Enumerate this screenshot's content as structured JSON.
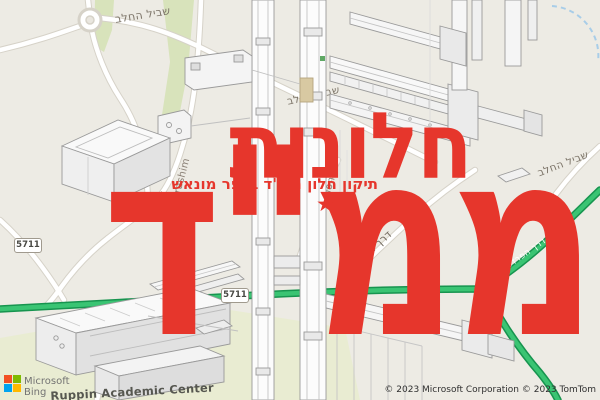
{
  "theme": {
    "accent_red": "#e6362c",
    "road_green_fill": "#3ac473",
    "road_green_edge": "#17944f",
    "map_bg": "#edebe4",
    "veg_green": "#d8e3bb",
    "campus_green": "#e9ecd2",
    "water_blue": "#a8cde8",
    "label_gray": "#7c7468",
    "cad_line": "#9a9a9a",
    "logo_red": "#f25022",
    "logo_green": "#7fba00",
    "logo_blue": "#00a4ef",
    "logo_yellow": "#ffb900"
  },
  "overlay": {
    "title_line1": "חלונות",
    "title_line2": "ממ\"ד",
    "subtitle": "תיקון חלון ממ\"ד בכפר מונאש",
    "star": "★"
  },
  "map": {
    "shield1": "5711",
    "shield2": "5711",
    "labels": {
      "street_top_left": "שביל החלב",
      "street_center": "שביל החלב",
      "street_right": "שביל החלב",
      "street_green_road": "דרך הפרדסים",
      "street_diagonal": "דרך הפרדסים",
      "street_derekh": "Derekh",
      "street_haprashim": "Haprashim",
      "street_harimon": "Derekh Harimon",
      "poi_campus": "Ruppin Academic Center"
    }
  },
  "attribution": {
    "logo_line1": "Microsoft",
    "logo_line2": "Bing",
    "copyright": "© 2023 Microsoft Corporation © 2023 TomTom"
  }
}
